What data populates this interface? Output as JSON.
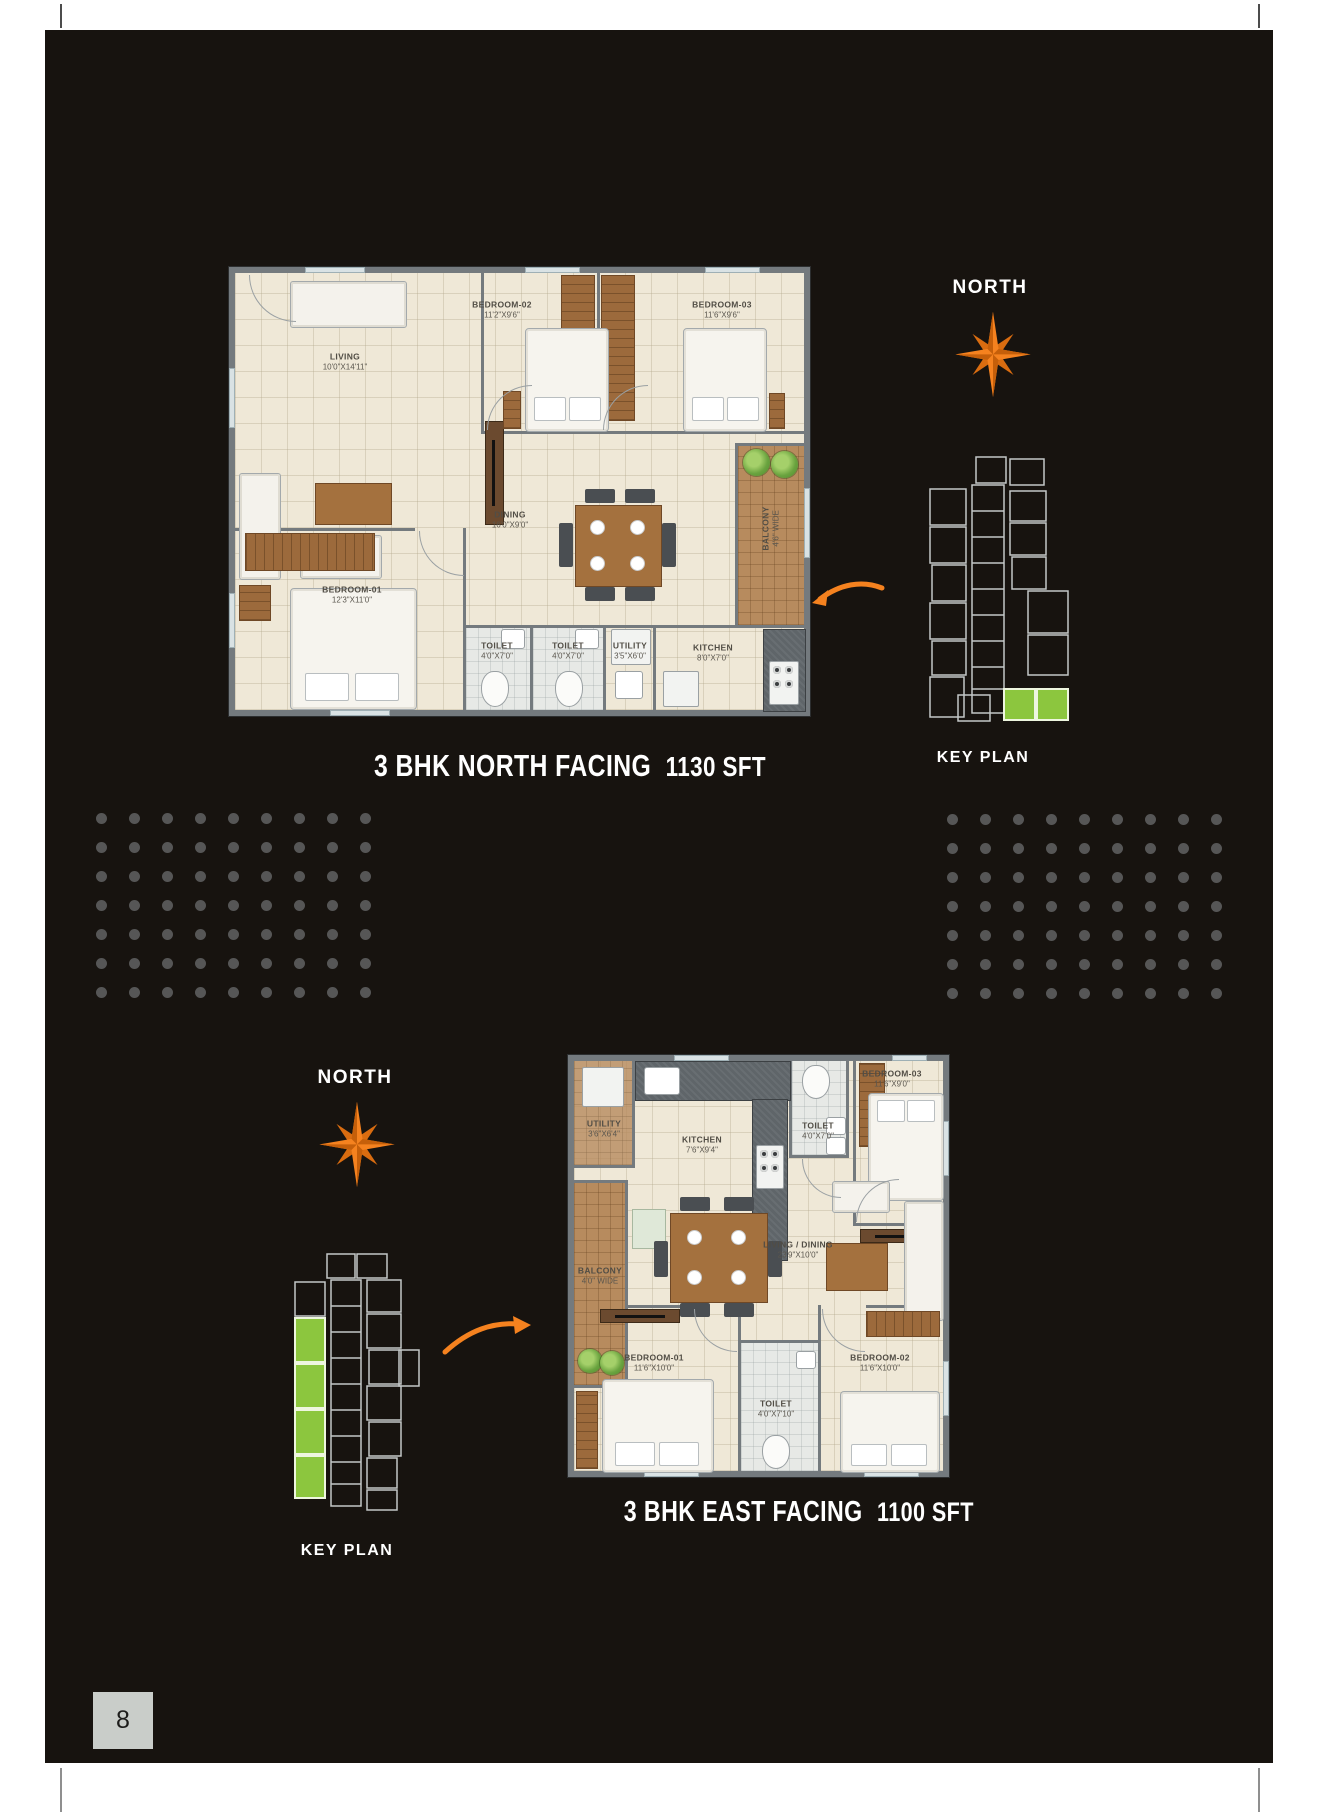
{
  "page": {
    "number": "8"
  },
  "colors": {
    "accent_orange": "#f5821f",
    "keyplan_green": "#8cc63e",
    "page_background": "#17130f",
    "dot_gray": "#565656"
  },
  "decor": {
    "dots": {
      "rows": 7,
      "cols": 9
    }
  },
  "top_section": {
    "north_label": "NORTH",
    "keyplan_label": "KEY PLAN",
    "caption_title": "3 BHK NORTH FACING",
    "caption_area": "1130 SFT",
    "rooms": {
      "living": {
        "name": "LIVING",
        "dims": "10'0\"X14'11\""
      },
      "bedroom2": {
        "name": "BEDROOM-02",
        "dims": "11'2\"X9'6\""
      },
      "bedroom3": {
        "name": "BEDROOM-03",
        "dims": "11'6\"X9'6\""
      },
      "dining": {
        "name": "DINING",
        "dims": "16'0\"X9'0\""
      },
      "bedroom1": {
        "name": "BEDROOM-01",
        "dims": "12'3\"X11'0\""
      },
      "toilet1": {
        "name": "TOILET",
        "dims": "4'0\"X7'0\""
      },
      "toilet2": {
        "name": "TOILET",
        "dims": "4'0\"X7'0\""
      },
      "utility": {
        "name": "UTILITY",
        "dims": "3'5\"X6'0\""
      },
      "kitchen": {
        "name": "KITCHEN",
        "dims": "8'0\"X7'0\""
      },
      "balcony": {
        "name": "BALCONY",
        "dims": "4'6\" WIDE"
      }
    }
  },
  "bottom_section": {
    "north_label": "NORTH",
    "keyplan_label": "KEY PLAN",
    "caption_title": "3 BHK EAST FACING",
    "caption_area": "1100 SFT",
    "rooms": {
      "utility": {
        "name": "UTILITY",
        "dims": "3'6\"X6'4\""
      },
      "kitchen": {
        "name": "KITCHEN",
        "dims": "7'6\"X9'4\""
      },
      "toilet_top": {
        "name": "TOILET",
        "dims": "4'0\"X7'0\""
      },
      "bedroom3": {
        "name": "BEDROOM-03",
        "dims": "11'6\"X9'0\""
      },
      "balcony": {
        "name": "BALCONY",
        "dims": "4'0\" WIDE"
      },
      "living": {
        "name": "LIVING / DINING",
        "dims": "23'9\"X10'0\""
      },
      "bedroom1": {
        "name": "BEDROOM-01",
        "dims": "11'6\"X10'0\""
      },
      "toilet_bottom": {
        "name": "TOILET",
        "dims": "4'0\"X7'10\""
      },
      "bedroom2": {
        "name": "BEDROOM-02",
        "dims": "11'6\"X10'0\""
      }
    }
  }
}
